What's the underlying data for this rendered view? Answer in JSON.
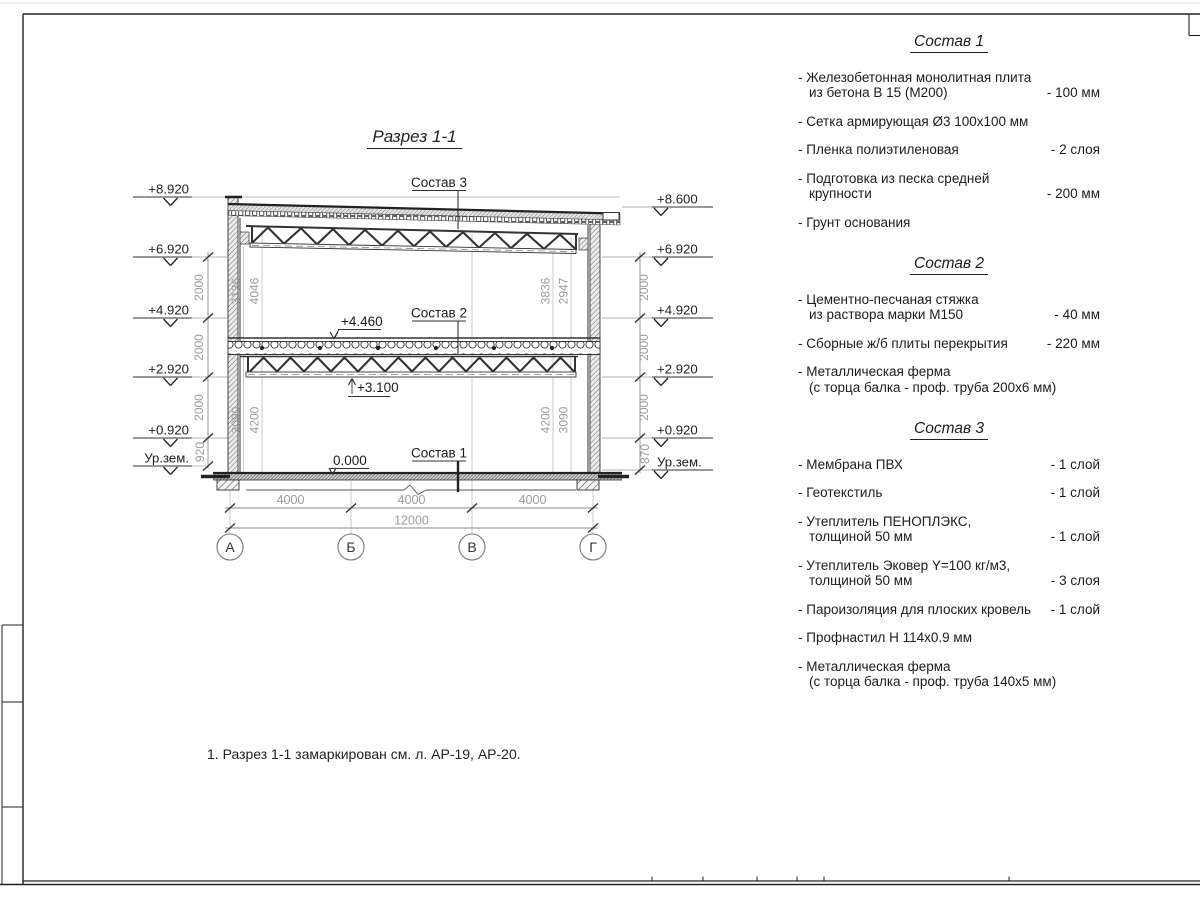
{
  "sheet": {
    "title": "Разрез 1-1",
    "note": "1. Разрез 1-1 замаркирован см. л. АР-19, АР-20."
  },
  "drawing": {
    "labels": {
      "sostav1": "Состав 1",
      "sostav2": "Состав 2",
      "sostav3": "Состав 3"
    },
    "levels": {
      "mid_top": "+4.460",
      "mid_truss": "+3.100",
      "floor": "0.000"
    },
    "left_marks": [
      "+8.920",
      "+6.920",
      "+4.920",
      "+2.920",
      "+0.920",
      "Ур.зем."
    ],
    "right_marks": [
      "+8.600",
      "+6.920",
      "+4.920",
      "+2.920",
      "+0.920",
      "Ур.зем."
    ],
    "chain_left": [
      "2000",
      "2000",
      "2000",
      "920"
    ],
    "chain_right": [
      "2000",
      "2000",
      "2000",
      "870"
    ],
    "inner_dims": {
      "tl1": "3136",
      "tl2": "4046",
      "tr1": "3836",
      "tr2": "2947",
      "bl1": "3090",
      "bl2": "4200",
      "br1": "4200",
      "br2": "3090"
    },
    "axes": [
      "А",
      "Б",
      "В",
      "Г"
    ],
    "spans": [
      "4000",
      "4000",
      "4000"
    ],
    "total": "12000"
  },
  "specs": {
    "sections": [
      {
        "title": "Состав 1",
        "items": [
          {
            "name": "- Железобетонная  монолитная плита\nиз бетона В 15 (М200)",
            "value": "- 100 мм"
          },
          {
            "name": "- Сетка армирующая Ø3 100х100 мм",
            "value": ""
          },
          {
            "name": "- Пленка полиэтиленовая",
            "value": "-  2 слоя"
          },
          {
            "name": "- Подготовка из песка средней\nкрупности",
            "value": "- 200 мм"
          },
          {
            "name": "- Грунт основания",
            "value": ""
          }
        ]
      },
      {
        "title": "Состав 2",
        "items": [
          {
            "name": "- Цементно-песчаная стяжка\nиз раствора марки М150",
            "value": "- 40 мм"
          },
          {
            "name": "- Сборные ж/б плиты перекрытия",
            "value": "- 220 мм"
          },
          {
            "name": "- Металлическая ферма\n(с торца балка - проф. труба 200х6 мм)",
            "value": ""
          }
        ]
      },
      {
        "title": "Состав 3",
        "items": [
          {
            "name": "- Мембрана ПВХ",
            "value": "- 1 слой"
          },
          {
            "name": "- Геотекстиль",
            "value": "- 1 слой"
          },
          {
            "name": "- Утеплитель ПЕНОПЛЭКС,\nтолщиной 50 мм",
            "value": "- 1 слой"
          },
          {
            "name": "- Утеплитель Эковер Y=100 кг/м3,\nтолщиной 50 мм",
            "value": "- 3 слоя"
          },
          {
            "name": "- Пароизоляция для плоских кровель",
            "value": "- 1 слой"
          },
          {
            "name": "- Профнастил Н 114х0.9 мм",
            "value": ""
          },
          {
            "name": "- Металлическая ферма\n(с торца балка - проф. труба 140х5 мм)",
            "value": ""
          }
        ]
      }
    ]
  },
  "colors": {
    "line": "#1a1a1a",
    "dim": "#9c9c9c",
    "accent": "#555555"
  }
}
